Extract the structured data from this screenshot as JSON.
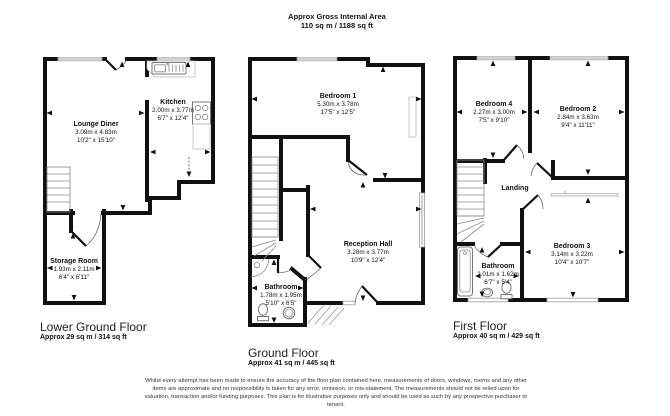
{
  "header": {
    "title": "Approx Gross Internal Area",
    "subtitle": "110 sq m / 1188 sq ft"
  },
  "floors": {
    "lower": {
      "title": "Lower Ground Floor",
      "area": "Approx 29 sq m / 314 sq ft",
      "rooms": {
        "lounge": {
          "name": "Lounge Diner",
          "metric": "3.09m x 4.83m",
          "imperial": "10'2\" x 15'10\""
        },
        "kitchen": {
          "name": "Kitchen",
          "metric": "2.00m x 3.77m",
          "imperial": "6'7\" x 12'4\""
        },
        "storage": {
          "name": "Storage Room",
          "metric": "1.93m x 2.11m",
          "imperial": "6'4\" x 6'11\""
        }
      }
    },
    "ground": {
      "title": "Ground Floor",
      "area": "Approx 41 sq m / 445 sq ft",
      "rooms": {
        "bedroom1": {
          "name": "Bedroom 1",
          "metric": "5.30m x 3.78m",
          "imperial": "17'5\" x 12'5\""
        },
        "reception": {
          "name": "Reception Hall",
          "metric": "3.28m x 3.77m",
          "imperial": "10'9\" x 12'4\""
        },
        "bathroom": {
          "name": "Bathroom",
          "metric": "1.78m x 1.95m",
          "imperial": "5'10\" x 6'5\""
        }
      }
    },
    "first": {
      "title": "First Floor",
      "area": "Approx 40 sq m / 429 sq ft",
      "rooms": {
        "bedroom4": {
          "name": "Bedroom 4",
          "metric": "2.27m x 3.00m",
          "imperial": "7'5\" x 9'10\""
        },
        "bedroom2": {
          "name": "Bedroom 2",
          "metric": "2.84m x 3.63m",
          "imperial": "9'4\" x 11'11\""
        },
        "bedroom3": {
          "name": "Bedroom 3",
          "metric": "3.14m x 3.22m",
          "imperial": "10'4\" x 10'7\""
        },
        "bathroom": {
          "name": "Bathroom",
          "metric": "2.01m x 1.62m",
          "imperial": "6'7\" x 5'4\""
        },
        "landing": {
          "name": "Landing"
        }
      }
    }
  },
  "disclaimer": "Whilst every attempt has been made to ensure the accuracy of the floor plan contained here, measurements of doors, windows, rooms and any other items are approximate and no responsibility is taken for any error, omission, or mis-statement. The measurements should not be relied upon for valuation, transaction and/or funding purposes. This plan is for illustrative purposes only and should be used as such by any prospective purchaser or tenant.",
  "colors": {
    "wall": "#111111",
    "fixture_gray": "#8a8a8a"
  }
}
